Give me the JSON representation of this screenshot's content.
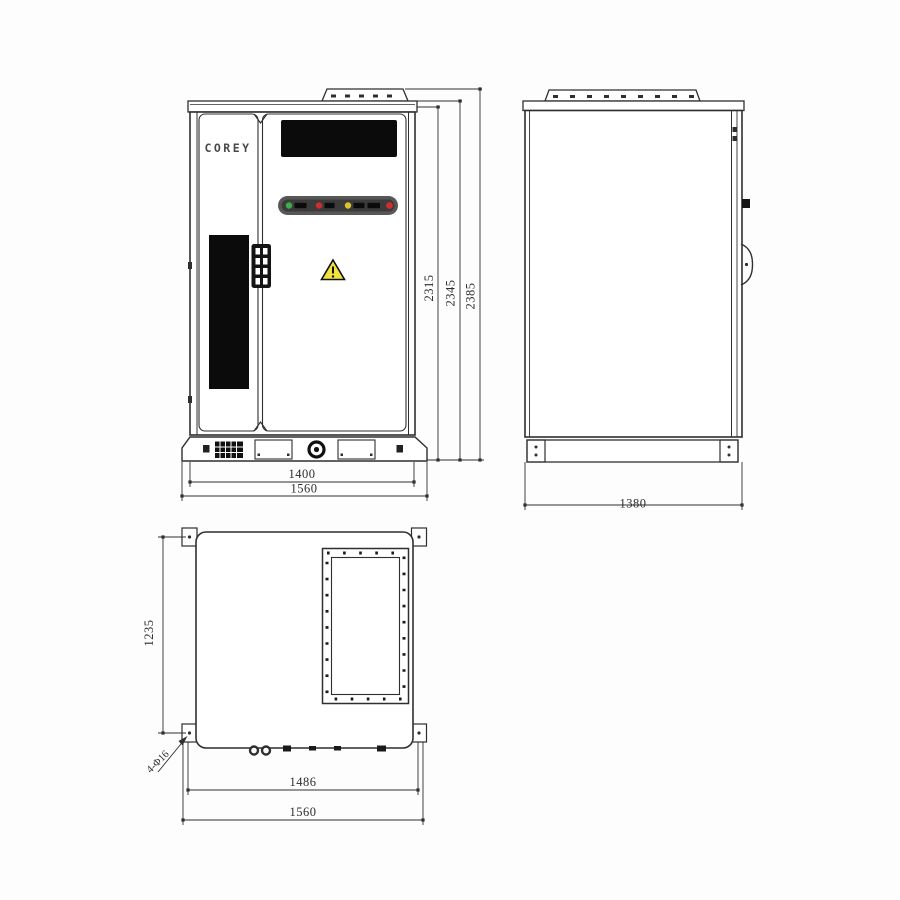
{
  "brand": {
    "logo": "COREY"
  },
  "front_view": {
    "dim_height_body": "2315",
    "dim_height_cap": "2345",
    "dim_height_rail": "2385",
    "dim_width_inner": "1400",
    "dim_width_outer": "1560"
  },
  "side_view": {
    "dim_depth": "1380"
  },
  "bottom_view": {
    "dim_depth": "1235",
    "dim_width_inner": "1486",
    "dim_width_outer": "1560",
    "hole_callout": "4-Φ16"
  },
  "colors": {
    "line": "#2f2f2f",
    "panel_black": "#0b0b0b",
    "led_green": "#3fae4a",
    "led_red": "#cf2e2e",
    "led_amber": "#d9c32a",
    "warning_yellow": "#f0e23c"
  }
}
